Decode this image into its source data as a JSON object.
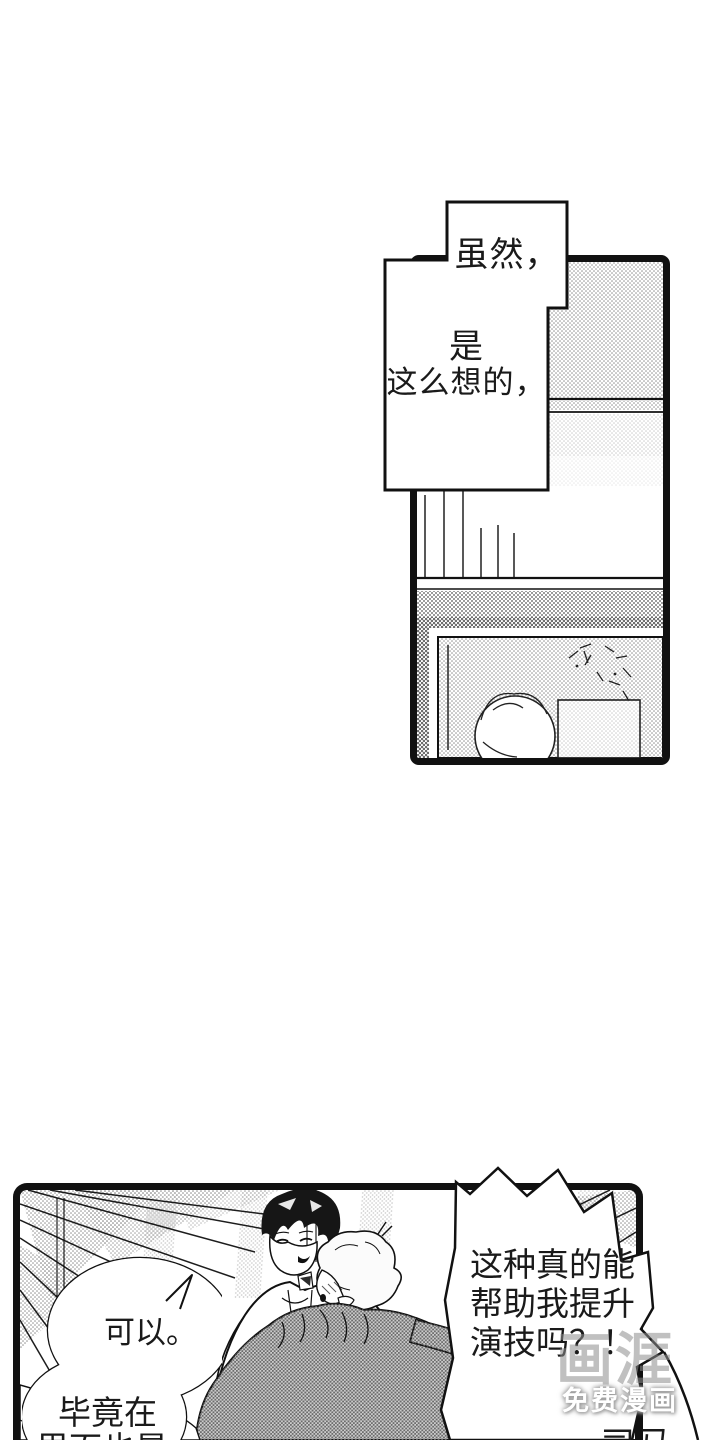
{
  "page": {
    "type": "comic-page",
    "background_color": "#ffffff",
    "ink_color": "#111111",
    "tone_color": "#8f8f8f"
  },
  "top_panel": {
    "caption": {
      "line1": "虽然，",
      "line2": "是",
      "line3": "这么想的，"
    }
  },
  "bottom_panel": {
    "bubble_left": {
      "line1": "可以。",
      "line2": "毕竟在",
      "line3": "里面也是"
    },
    "bubble_right": {
      "line1": "这种真的能",
      "line2": "帮助我提升",
      "line3": "演技吗？！"
    },
    "bubble_corner": {
      "line1": "司马"
    }
  },
  "watermark": {
    "logo_text": "画涯",
    "tagline": "免费漫画",
    "color": "#9e9e9e"
  }
}
